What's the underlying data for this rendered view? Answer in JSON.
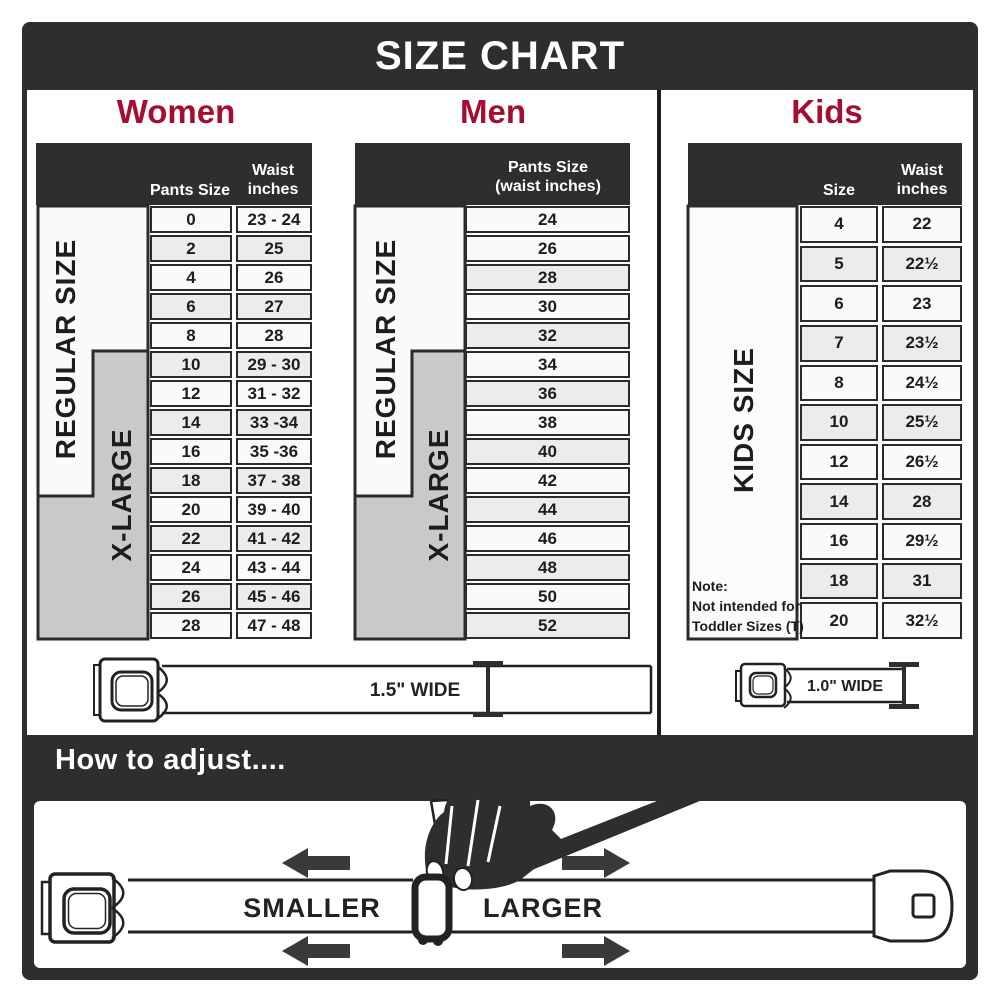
{
  "banner": {
    "title": "SIZE CHART"
  },
  "colors": {
    "accent": "#A50E33",
    "dark": "#2E2E2E",
    "row_light": "#FAFAFA",
    "row_shaded": "#ECECEC",
    "xlarge_gray": "#C9C9C9"
  },
  "women": {
    "title": "Women",
    "header": {
      "pants": "Pants Size",
      "waist": "Waist inches"
    },
    "regular_label": "REGULAR SIZE",
    "xlarge_label": "X-LARGE",
    "rows": [
      {
        "size": "0",
        "waist": "23 - 24"
      },
      {
        "size": "2",
        "waist": "25"
      },
      {
        "size": "4",
        "waist": "26"
      },
      {
        "size": "6",
        "waist": "27"
      },
      {
        "size": "8",
        "waist": "28"
      },
      {
        "size": "10",
        "waist": "29 - 30"
      },
      {
        "size": "12",
        "waist": "31 - 32"
      },
      {
        "size": "14",
        "waist": "33 -34"
      },
      {
        "size": "16",
        "waist": "35 -36"
      },
      {
        "size": "18",
        "waist": "37 - 38"
      },
      {
        "size": "20",
        "waist": "39 - 40"
      },
      {
        "size": "22",
        "waist": "41 - 42"
      },
      {
        "size": "24",
        "waist": "43 - 44"
      },
      {
        "size": "26",
        "waist": "45 - 46"
      },
      {
        "size": "28",
        "waist": "47 - 48"
      }
    ]
  },
  "men": {
    "title": "Men",
    "header": "Pants Size (waist inches)",
    "regular_label": "REGULAR SIZE",
    "xlarge_label": "X-LARGE",
    "rows": [
      "24",
      "26",
      "28",
      "30",
      "32",
      "34",
      "36",
      "38",
      "40",
      "42",
      "44",
      "46",
      "48",
      "50",
      "52"
    ]
  },
  "kids": {
    "title": "Kids",
    "header": {
      "size": "Size",
      "waist": "Waist inches"
    },
    "label": "KIDS SIZE",
    "note": {
      "line1": "Note:",
      "line2": "Not intended for",
      "line3": "Toddler Sizes (T)"
    },
    "rows": [
      {
        "size": "4",
        "waist": "22"
      },
      {
        "size": "5",
        "waist": "22½"
      },
      {
        "size": "6",
        "waist": "23"
      },
      {
        "size": "7",
        "waist": "23½"
      },
      {
        "size": "8",
        "waist": "24½"
      },
      {
        "size": "10",
        "waist": "25½"
      },
      {
        "size": "12",
        "waist": "26½"
      },
      {
        "size": "14",
        "waist": "28"
      },
      {
        "size": "16",
        "waist": "29½"
      },
      {
        "size": "18",
        "waist": "31"
      },
      {
        "size": "20",
        "waist": "32½"
      }
    ]
  },
  "belts": {
    "adult": "1.5\" WIDE",
    "kids": "1.0\" WIDE"
  },
  "adjust": {
    "heading": "How to adjust....",
    "smaller": "SMALLER",
    "larger": "LARGER"
  }
}
